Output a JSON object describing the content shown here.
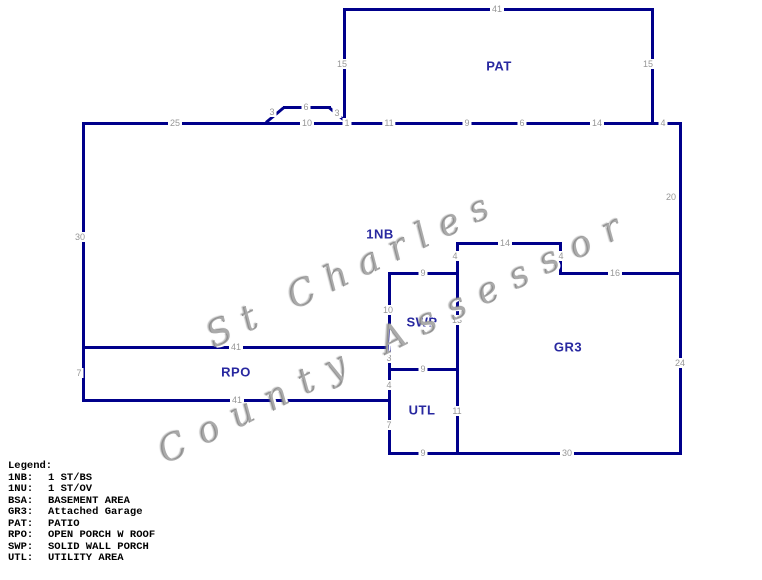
{
  "watermark": {
    "line1": "St Charles",
    "line2": "County Assessor"
  },
  "legend": {
    "title": "Legend:",
    "entries": [
      {
        "code": "1NB:",
        "desc": "1 ST/BS"
      },
      {
        "code": "1NU:",
        "desc": "1 ST/OV"
      },
      {
        "code": "BSA:",
        "desc": "BASEMENT AREA"
      },
      {
        "code": "GR3:",
        "desc": "Attached Garage"
      },
      {
        "code": "PAT:",
        "desc": "PATIO"
      },
      {
        "code": "RPO:",
        "desc": "OPEN PORCH W ROOF"
      },
      {
        "code": "SWP:",
        "desc": "SOLID WALL PORCH"
      },
      {
        "code": "UTL:",
        "desc": "UTILITY AREA"
      }
    ]
  },
  "sketch": {
    "line_color": "#00008B",
    "label_color": "#2828A0",
    "dim_color": "#979797",
    "areas": [
      {
        "code": "PAT",
        "x": 499,
        "y": 66
      },
      {
        "code": "1NB",
        "x": 380,
        "y": 234
      },
      {
        "code": "SWP",
        "x": 422,
        "y": 322
      },
      {
        "code": "GR3",
        "x": 568,
        "y": 347
      },
      {
        "code": "RPO",
        "x": 236,
        "y": 372
      },
      {
        "code": "UTL",
        "x": 422,
        "y": 410
      }
    ],
    "dimensions": [
      {
        "t": "41",
        "x": 497,
        "y": 9
      },
      {
        "t": "15",
        "x": 342,
        "y": 64
      },
      {
        "t": "15",
        "x": 648,
        "y": 64
      },
      {
        "t": "3",
        "x": 272,
        "y": 112
      },
      {
        "t": "6",
        "x": 306,
        "y": 107
      },
      {
        "t": "3",
        "x": 337,
        "y": 113
      },
      {
        "t": "25",
        "x": 175,
        "y": 123
      },
      {
        "t": "10",
        "x": 307,
        "y": 123
      },
      {
        "t": "1",
        "x": 347,
        "y": 123
      },
      {
        "t": "11",
        "x": 389,
        "y": 123
      },
      {
        "t": "9",
        "x": 467,
        "y": 123
      },
      {
        "t": "6",
        "x": 522,
        "y": 123
      },
      {
        "t": "14",
        "x": 597,
        "y": 123
      },
      {
        "t": "4",
        "x": 663,
        "y": 123
      },
      {
        "t": "30",
        "x": 80,
        "y": 237
      },
      {
        "t": "20",
        "x": 671,
        "y": 197
      },
      {
        "t": "14",
        "x": 505,
        "y": 243
      },
      {
        "t": "4",
        "x": 455,
        "y": 256
      },
      {
        "t": "4",
        "x": 561,
        "y": 256
      },
      {
        "t": "9",
        "x": 423,
        "y": 273
      },
      {
        "t": "16",
        "x": 615,
        "y": 273
      },
      {
        "t": "10",
        "x": 388,
        "y": 310
      },
      {
        "t": "13",
        "x": 457,
        "y": 320
      },
      {
        "t": "41",
        "x": 236,
        "y": 347
      },
      {
        "t": "3",
        "x": 389,
        "y": 358
      },
      {
        "t": "24",
        "x": 680,
        "y": 363
      },
      {
        "t": "9",
        "x": 423,
        "y": 369
      },
      {
        "t": "7",
        "x": 79,
        "y": 373
      },
      {
        "t": "4",
        "x": 389,
        "y": 385
      },
      {
        "t": "41",
        "x": 237,
        "y": 400
      },
      {
        "t": "11",
        "x": 457,
        "y": 411
      },
      {
        "t": "7",
        "x": 389,
        "y": 425
      },
      {
        "t": "9",
        "x": 423,
        "y": 453
      },
      {
        "t": "30",
        "x": 567,
        "y": 453
      }
    ],
    "walls": [
      {
        "x": 343,
        "y": 8,
        "len": 311,
        "dir": "h"
      },
      {
        "x": 343,
        "y": 8,
        "len": 117,
        "dir": "v"
      },
      {
        "x": 651,
        "y": 8,
        "len": 117,
        "dir": "v"
      },
      {
        "x": 82,
        "y": 122,
        "len": 597,
        "dir": "h"
      },
      {
        "x": 266,
        "y": 121,
        "len": 23,
        "dir": "d",
        "angle": -40
      },
      {
        "x": 283,
        "y": 106,
        "len": 48,
        "dir": "h"
      },
      {
        "x": 329,
        "y": 106,
        "len": 23,
        "dir": "d",
        "angle": 40
      },
      {
        "x": 82,
        "y": 122,
        "len": 227,
        "dir": "v"
      },
      {
        "x": 679,
        "y": 122,
        "len": 333,
        "dir": "v"
      },
      {
        "x": 456,
        "y": 242,
        "len": 106,
        "dir": "h"
      },
      {
        "x": 456,
        "y": 242,
        "len": 210,
        "dir": "v"
      },
      {
        "x": 559,
        "y": 242,
        "len": 33,
        "dir": "v"
      },
      {
        "x": 559,
        "y": 272,
        "len": 120,
        "dir": "h"
      },
      {
        "x": 388,
        "y": 272,
        "len": 71,
        "dir": "h"
      },
      {
        "x": 388,
        "y": 272,
        "len": 180,
        "dir": "v"
      },
      {
        "x": 82,
        "y": 346,
        "len": 309,
        "dir": "h"
      },
      {
        "x": 82,
        "y": 346,
        "len": 56,
        "dir": "v"
      },
      {
        "x": 82,
        "y": 399,
        "len": 309,
        "dir": "h"
      },
      {
        "x": 388,
        "y": 368,
        "len": 71,
        "dir": "h"
      },
      {
        "x": 388,
        "y": 452,
        "len": 294,
        "dir": "h"
      }
    ]
  }
}
